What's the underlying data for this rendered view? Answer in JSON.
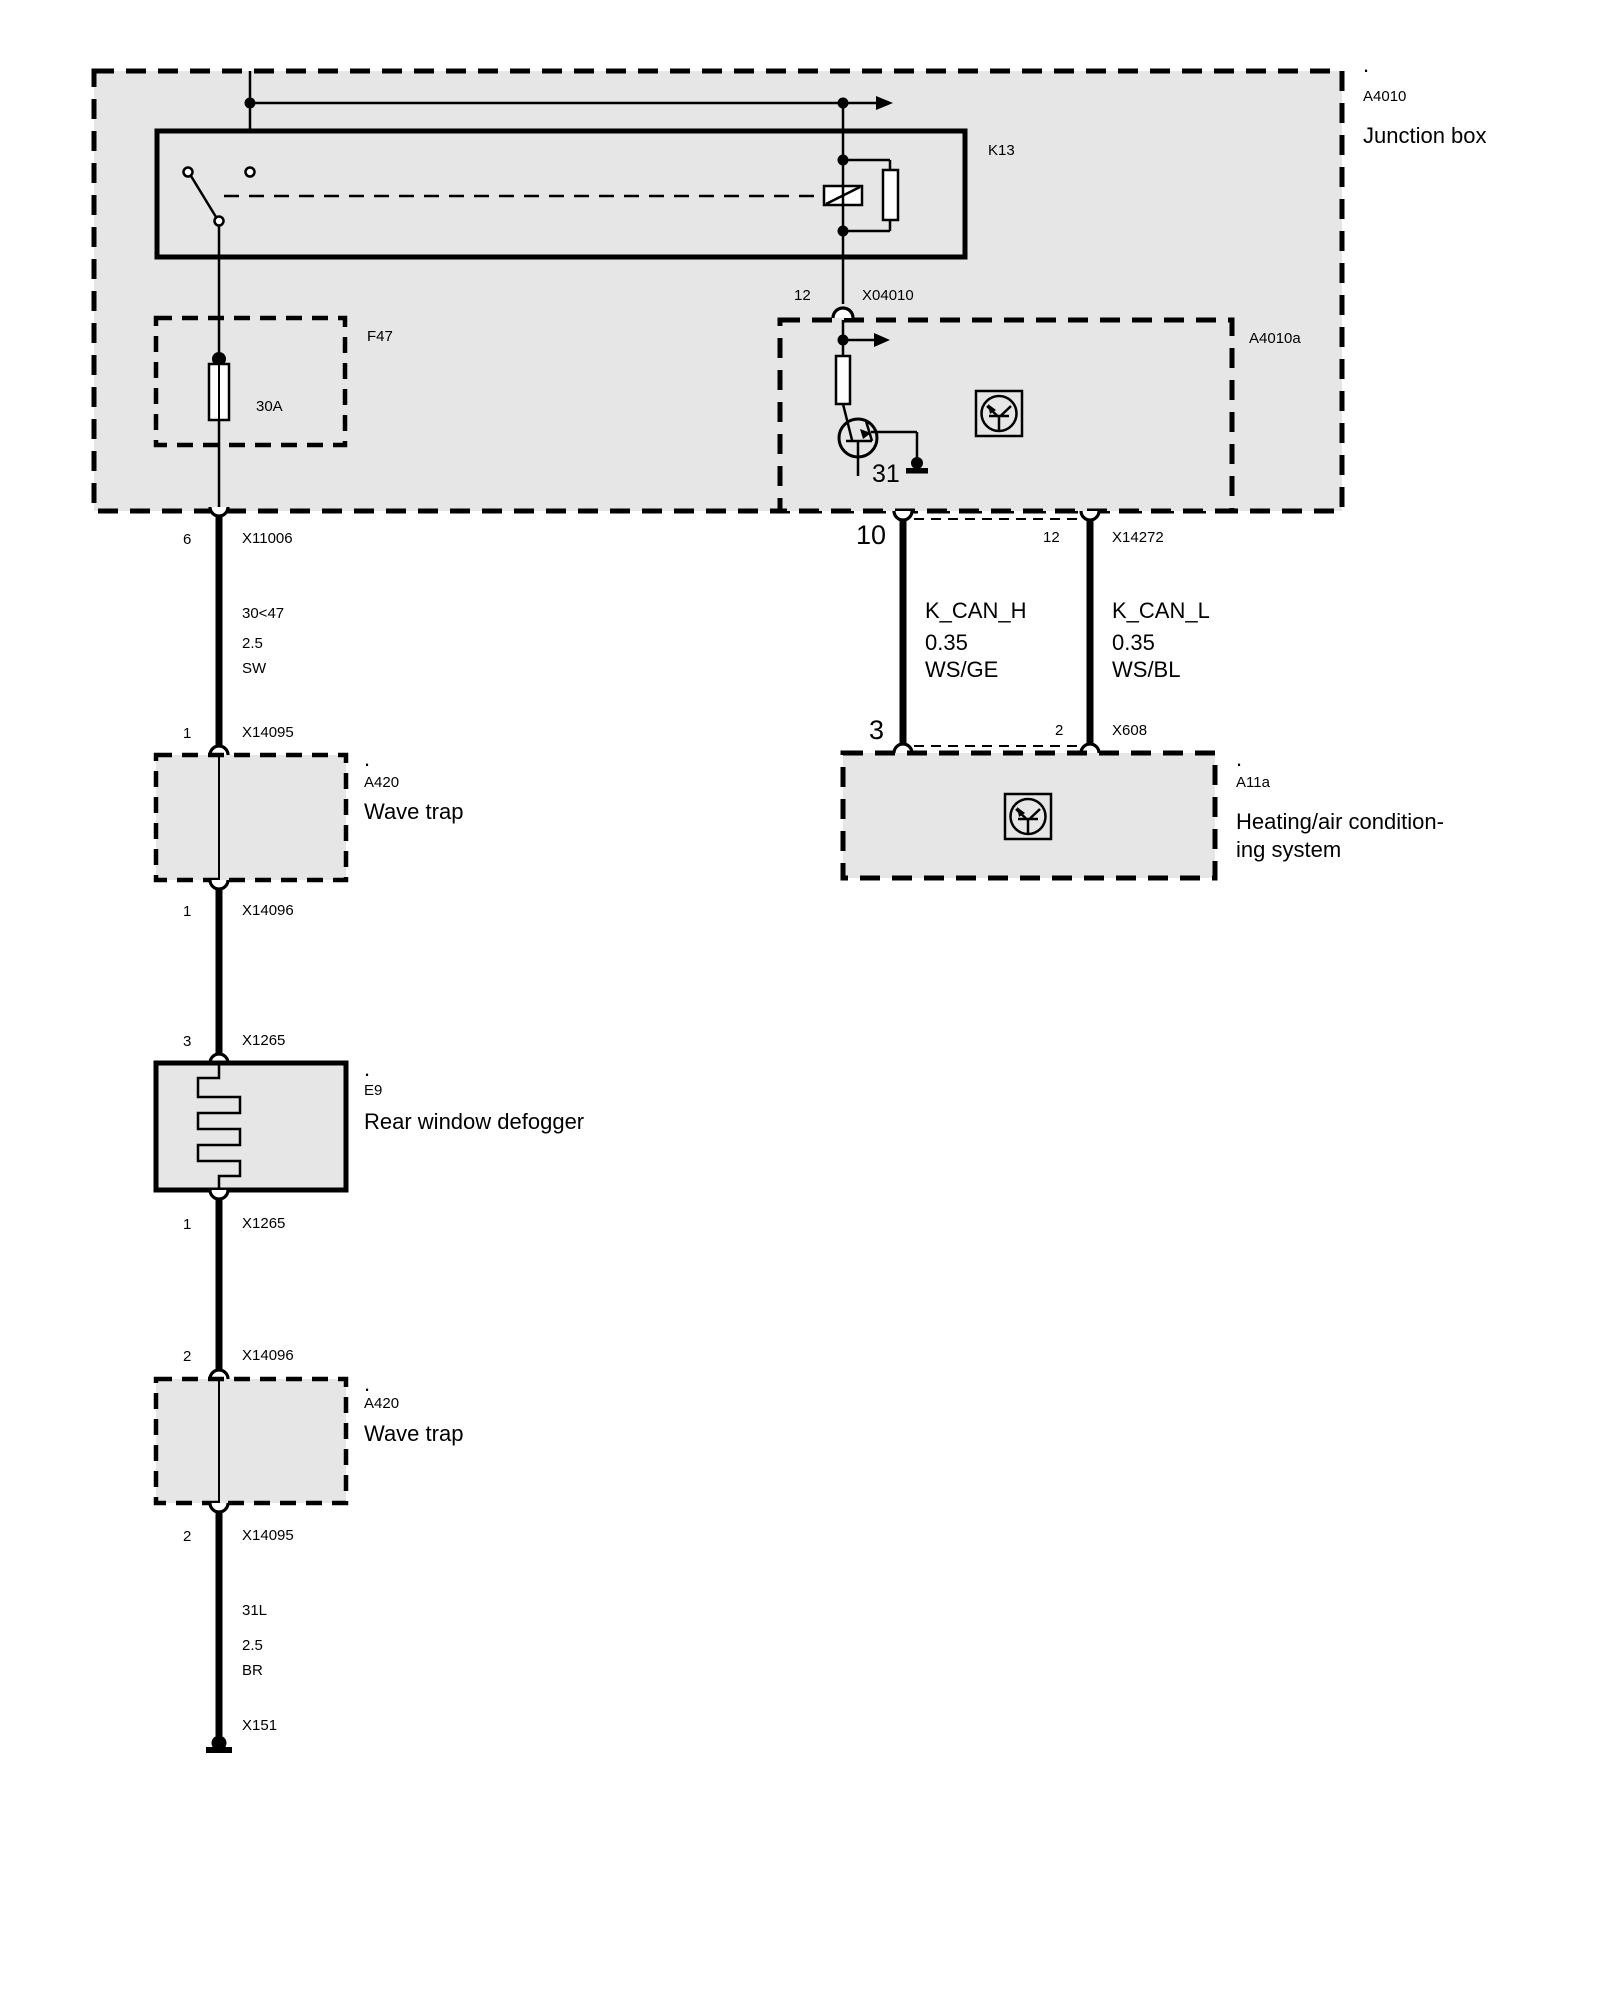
{
  "colors": {
    "box_fill": "#e6e6e6",
    "line": "#000000",
    "page_bg": "#ffffff"
  },
  "junction_box": {
    "marker": ".",
    "ref": "A4010",
    "name": "Junction box"
  },
  "relay": {
    "ref": "K13"
  },
  "fuse": {
    "ref": "F47",
    "rating": "30A"
  },
  "connector_x04010": {
    "pin": "12",
    "ref": "X04010"
  },
  "module_a4010a": {
    "ref": "A4010a",
    "ground_terminal": "31"
  },
  "can_bus": {
    "x14272": {
      "pin_left": "10",
      "pin_right": "12",
      "ref": "X14272"
    },
    "k_can_h": {
      "signal": "K_CAN_H",
      "gauge": "0.35",
      "color_code": "WS/GE"
    },
    "k_can_l": {
      "signal": "K_CAN_L",
      "gauge": "0.35",
      "color_code": "WS/BL"
    },
    "x608": {
      "pin_left": "3",
      "pin_right": "2",
      "ref": "X608"
    }
  },
  "hvac": {
    "marker": ".",
    "ref": "A11a",
    "name_line_1": "Heating/air condition-",
    "name_line_2": "ing system"
  },
  "wave_trap_1": {
    "marker": ".",
    "ref": "A420",
    "name": "Wave trap"
  },
  "defogger": {
    "marker": ".",
    "ref": "E9",
    "name": "Rear window defogger"
  },
  "wave_trap_2": {
    "marker": ".",
    "ref": "A420",
    "name": "Wave trap"
  },
  "left_branch": {
    "pins": [
      {
        "pin": "6",
        "ref": "X11006"
      },
      {
        "pin": "1",
        "ref": "X14095"
      },
      {
        "pin": "1",
        "ref": "X14096"
      },
      {
        "pin": "3",
        "ref": "X1265"
      },
      {
        "pin": "1",
        "ref": "X1265"
      },
      {
        "pin": "2",
        "ref": "X14096"
      },
      {
        "pin": "2",
        "ref": "X14095"
      }
    ],
    "wire_power": {
      "circuit": "30<47",
      "gauge": "2.5",
      "color_code": "SW"
    },
    "wire_ground": {
      "circuit": "31L",
      "gauge": "2.5",
      "color_code": "BR"
    },
    "ground_ref": "X151"
  }
}
